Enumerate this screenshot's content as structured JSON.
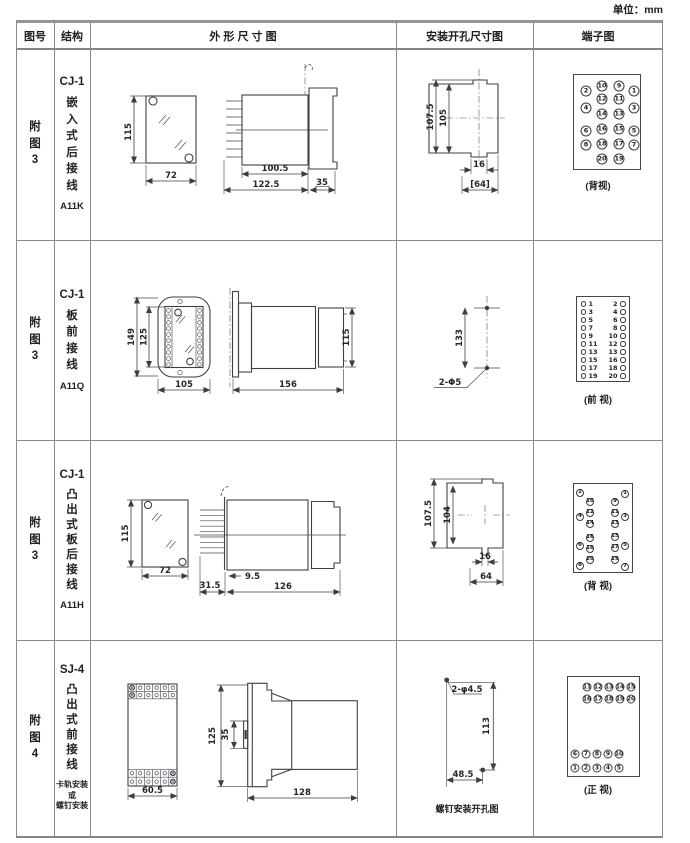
{
  "unit_label": "单位：mm",
  "headers": {
    "fig_no": "图号",
    "structure": "结构",
    "outline": "外 形 尺 寸 图",
    "install": "安装开孔尺寸图",
    "terminal": "端子图"
  },
  "rows": [
    {
      "fig_no": "附\n图\n3",
      "model": "CJ-1",
      "structure_text": "嵌\n入\n式\n后\n接\n线",
      "code": "A11K",
      "outline": {
        "h": "115",
        "w": "72",
        "l1": "100.5",
        "l2": "122.5",
        "l3": "35"
      },
      "install": {
        "v1": "107.5",
        "v2": "105",
        "w1": "16",
        "w2": "[64]"
      },
      "terminal": {
        "caption": "(背视)",
        "style": "grid",
        "d": 11,
        "f": 6.5,
        "pins": [
          {
            "n": "2",
            "x": 12,
            "y": 16
          },
          {
            "n": "10",
            "x": 28,
            "y": 11
          },
          {
            "n": "9",
            "x": 45,
            "y": 11
          },
          {
            "n": "1",
            "x": 60,
            "y": 16
          },
          {
            "n": "12",
            "x": 28,
            "y": 24
          },
          {
            "n": "11",
            "x": 45,
            "y": 24
          },
          {
            "n": "4",
            "x": 12,
            "y": 33
          },
          {
            "n": "14",
            "x": 28,
            "y": 39
          },
          {
            "n": "13",
            "x": 45,
            "y": 39
          },
          {
            "n": "3",
            "x": 60,
            "y": 33
          },
          {
            "n": "6",
            "x": 12,
            "y": 56
          },
          {
            "n": "16",
            "x": 28,
            "y": 54
          },
          {
            "n": "15",
            "x": 45,
            "y": 54
          },
          {
            "n": "5",
            "x": 60,
            "y": 56
          },
          {
            "n": "8",
            "x": 12,
            "y": 70
          },
          {
            "n": "18",
            "x": 28,
            "y": 69
          },
          {
            "n": "17",
            "x": 45,
            "y": 69
          },
          {
            "n": "7",
            "x": 60,
            "y": 70
          },
          {
            "n": "20",
            "x": 28,
            "y": 84
          },
          {
            "n": "19",
            "x": 45,
            "y": 84
          }
        ]
      }
    },
    {
      "fig_no": "附\n图\n3",
      "model": "CJ-1",
      "structure_text": "板\n前\n接\n线",
      "code": "A11Q",
      "outline": {
        "h1": "149",
        "h2": "125",
        "w": "105",
        "l": "156",
        "h3": "115"
      },
      "install": {
        "v": "133",
        "label": "2-Φ5"
      },
      "terminal": {
        "caption": "(前 视)",
        "style": "list",
        "rows": [
          [
            "1",
            "2"
          ],
          [
            "3",
            "4"
          ],
          [
            "5",
            "6"
          ],
          [
            "7",
            "8"
          ],
          [
            "9",
            "10"
          ],
          [
            "11",
            "12"
          ],
          [
            "13",
            "13"
          ],
          [
            "15",
            "16"
          ],
          [
            "17",
            "18"
          ],
          [
            "19",
            "20"
          ]
        ]
      }
    },
    {
      "fig_no": "附\n图\n3",
      "model": "CJ-1",
      "structure_text": "凸\n出\n式\n板\n后\n接\n线",
      "code": "A11H",
      "outline": {
        "h": "115",
        "w": "72",
        "l1": "9.5",
        "l2": "31.5",
        "l3": "126"
      },
      "install": {
        "v1": "107.5",
        "v2": "104",
        "w1": "16",
        "w2": "64"
      },
      "terminal": {
        "caption": "(背 视)",
        "style": "grid",
        "d": 8,
        "f": 5.5,
        "pins": [
          {
            "n": "2",
            "x": 6,
            "y": 9
          },
          {
            "n": "1",
            "x": 51,
            "y": 10
          },
          {
            "n": "10",
            "x": 16,
            "y": 18
          },
          {
            "n": "9",
            "x": 41,
            "y": 18
          },
          {
            "n": "12",
            "x": 16,
            "y": 29
          },
          {
            "n": "11",
            "x": 41,
            "y": 29
          },
          {
            "n": "4",
            "x": 6,
            "y": 33
          },
          {
            "n": "3",
            "x": 51,
            "y": 33
          },
          {
            "n": "14",
            "x": 16,
            "y": 40
          },
          {
            "n": "13",
            "x": 41,
            "y": 40
          },
          {
            "n": "16",
            "x": 16,
            "y": 54
          },
          {
            "n": "15",
            "x": 41,
            "y": 53
          },
          {
            "n": "6",
            "x": 6,
            "y": 62
          },
          {
            "n": "5",
            "x": 51,
            "y": 62
          },
          {
            "n": "18",
            "x": 16,
            "y": 65
          },
          {
            "n": "17",
            "x": 41,
            "y": 64
          },
          {
            "n": "20",
            "x": 16,
            "y": 76
          },
          {
            "n": "19",
            "x": 41,
            "y": 76
          },
          {
            "n": "8",
            "x": 6,
            "y": 82
          },
          {
            "n": "7",
            "x": 51,
            "y": 83
          }
        ]
      }
    },
    {
      "fig_no": "附\n图\n4",
      "model": "SJ-4",
      "structure_text": "凸\n出\n式\n前\n接\n线",
      "note": "卡轨安装\n或\n螺钉安装",
      "outline": {
        "w": "60.5",
        "h": "125",
        "rail": "35",
        "l": "128"
      },
      "install": {
        "label": "2-φ4.5",
        "v": "113",
        "w": "48.5",
        "caption": "螺钉安装开孔图"
      },
      "terminal": {
        "caption": "(正 视)",
        "style": "grid",
        "d": 9,
        "f": 6,
        "pins": [
          {
            "n": "11",
            "x": 19,
            "y": 10
          },
          {
            "n": "12",
            "x": 30,
            "y": 10
          },
          {
            "n": "13",
            "x": 41,
            "y": 10
          },
          {
            "n": "14",
            "x": 52,
            "y": 10
          },
          {
            "n": "15",
            "x": 63,
            "y": 10
          },
          {
            "n": "16",
            "x": 19,
            "y": 22
          },
          {
            "n": "17",
            "x": 30,
            "y": 22
          },
          {
            "n": "18",
            "x": 41,
            "y": 22
          },
          {
            "n": "19",
            "x": 52,
            "y": 22
          },
          {
            "n": "20",
            "x": 63,
            "y": 22
          },
          {
            "n": "6",
            "x": 7,
            "y": 77
          },
          {
            "n": "7",
            "x": 18,
            "y": 77
          },
          {
            "n": "8",
            "x": 29,
            "y": 77
          },
          {
            "n": "9",
            "x": 40,
            "y": 77
          },
          {
            "n": "10",
            "x": 51,
            "y": 77
          },
          {
            "n": "1",
            "x": 7,
            "y": 91
          },
          {
            "n": "2",
            "x": 18,
            "y": 91
          },
          {
            "n": "3",
            "x": 29,
            "y": 91
          },
          {
            "n": "4",
            "x": 40,
            "y": 91
          },
          {
            "n": "5",
            "x": 51,
            "y": 91
          }
        ]
      }
    }
  ]
}
